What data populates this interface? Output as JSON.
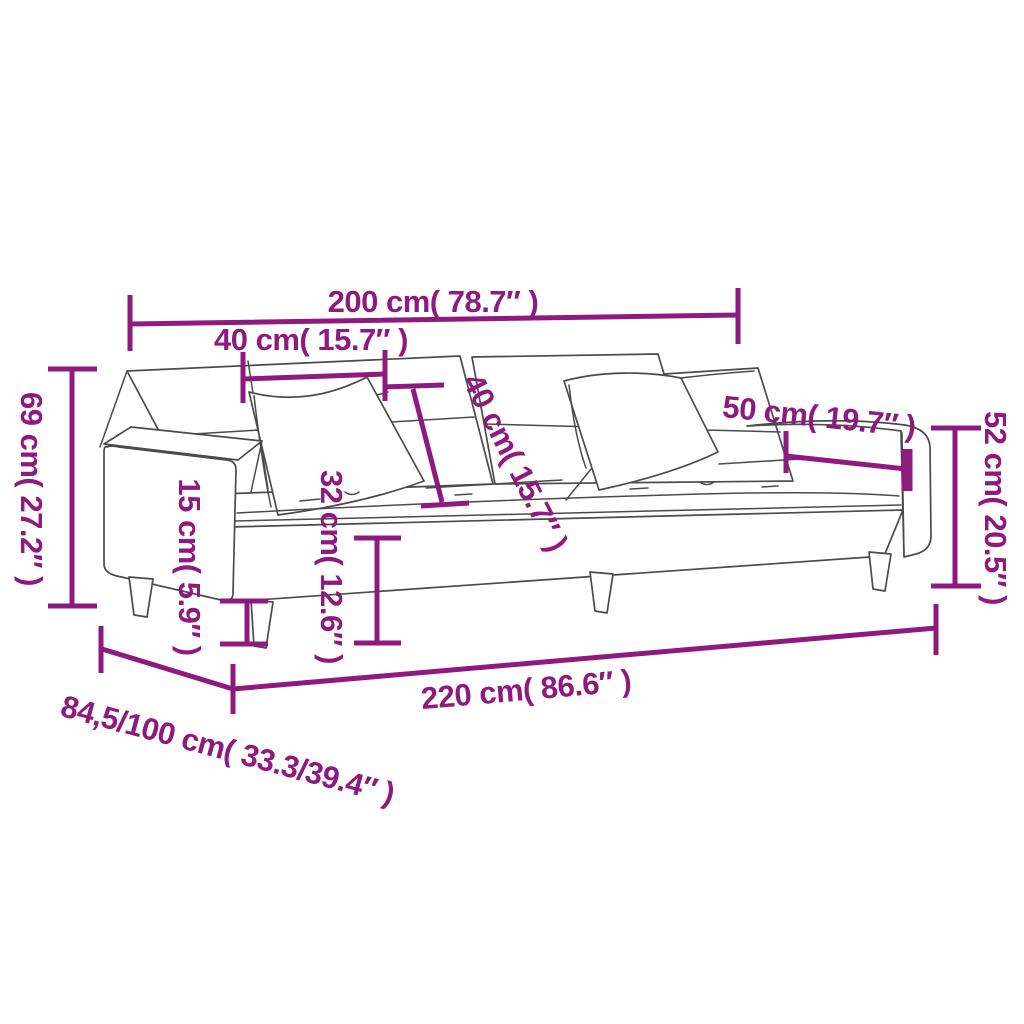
{
  "diagram": {
    "subject": "sofa-bed-with-two-pillows",
    "colors": {
      "dimension_accent": "#8E1A80",
      "drawing_outline": "#4B4B4B",
      "background": "#FFFFFF"
    },
    "dimensions": {
      "top_width": "200 cm( 78.7″ )",
      "back_cushion_width": "40 cm( 15.7″ )",
      "pillow_size": "40 cm( 15.7″ )",
      "pillow_width": "50 cm( 19.7″ )",
      "arm_height": "52 cm( 20.5″ )",
      "back_height": "69 cm( 27.2″ )",
      "leg_height": "15 cm( 5.9″ )",
      "seat_height": "32 cm( 12.6″ )",
      "total_length": "220 cm( 86.6″ )",
      "depth": "84,5/100 cm( 33.3/39.4″ )"
    }
  }
}
